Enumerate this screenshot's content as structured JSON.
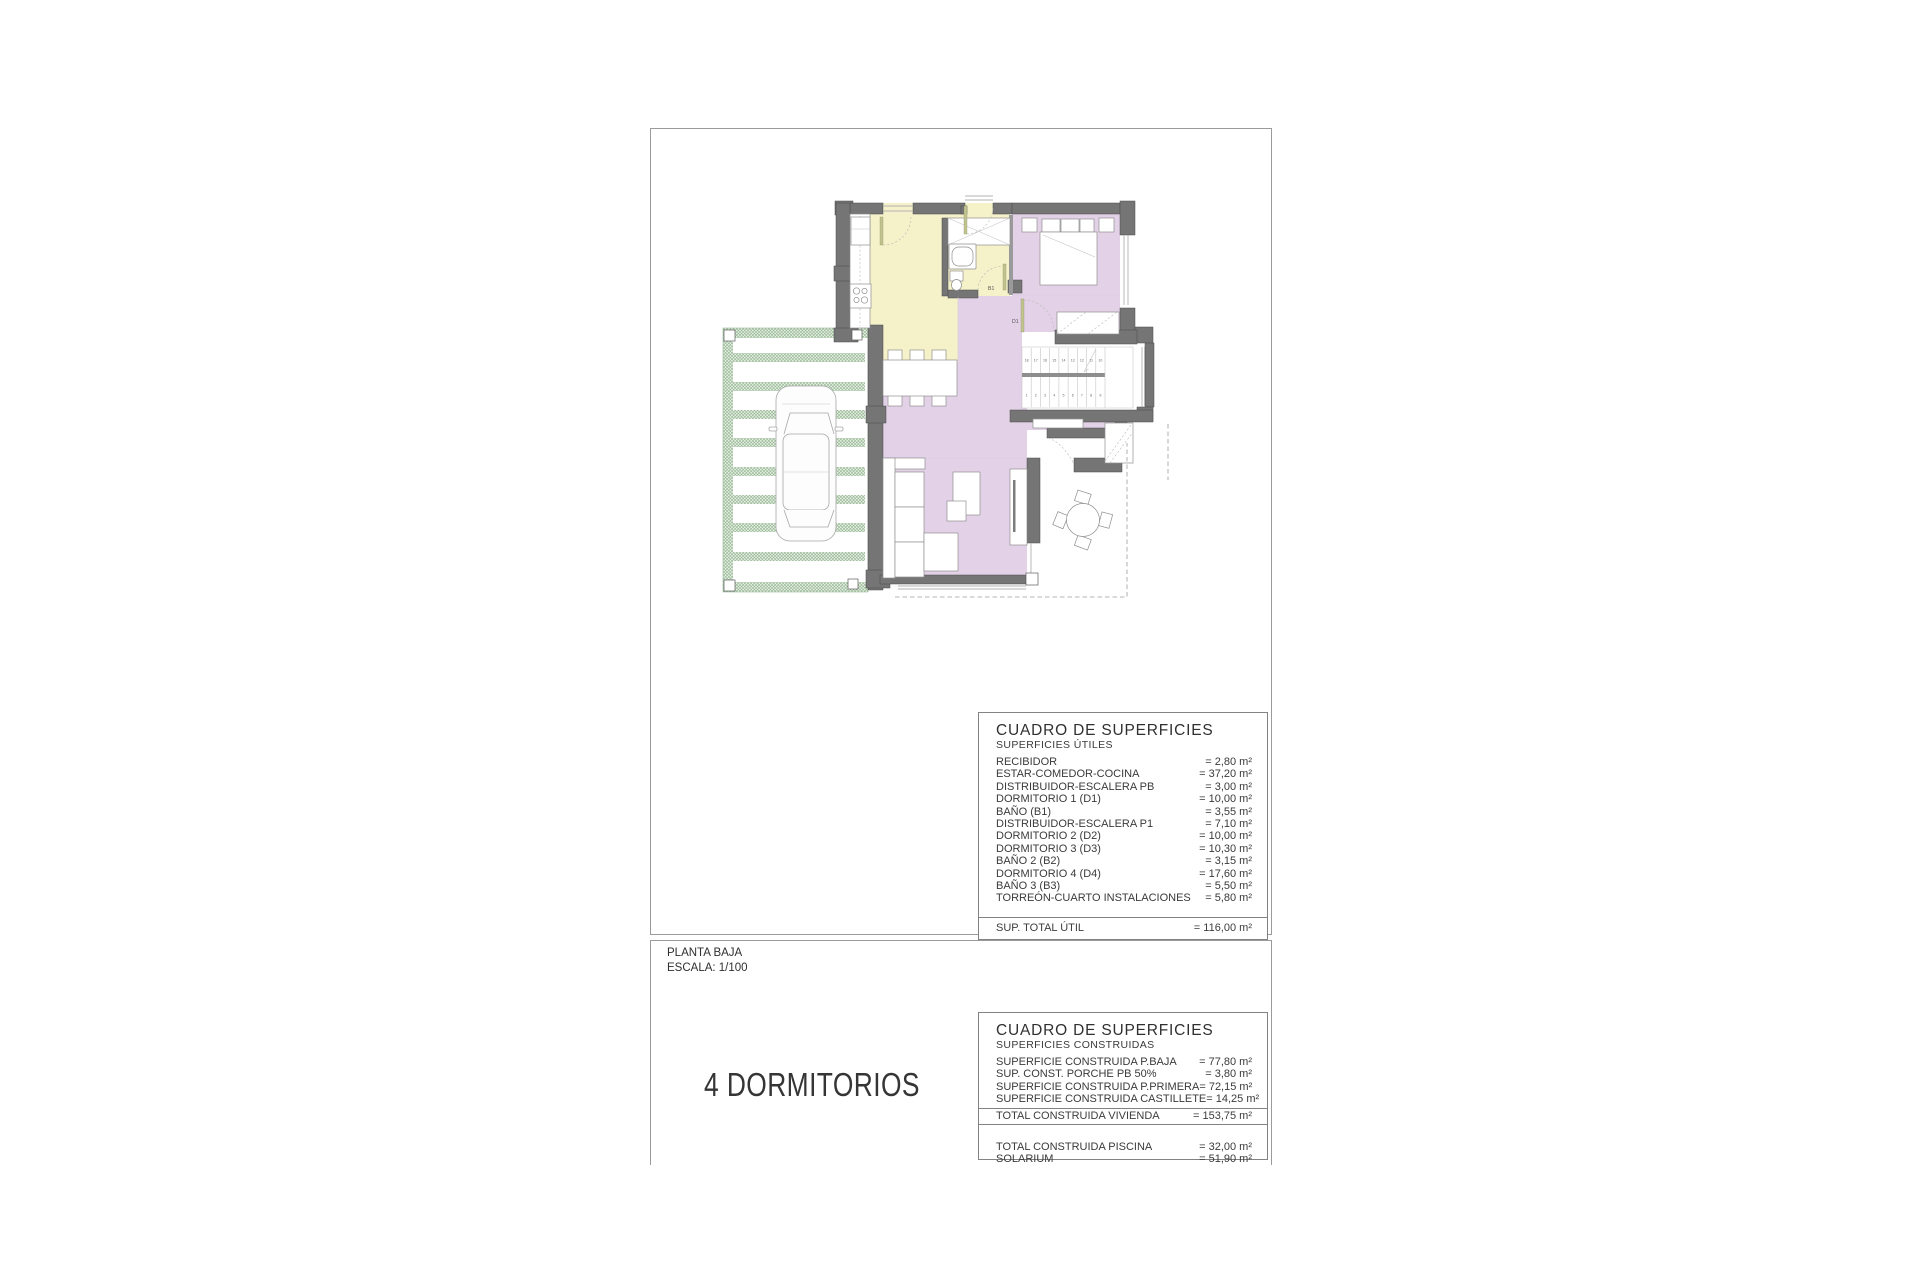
{
  "title_block": {
    "plan_name": "PLANTA BAJA",
    "scale": "ESCALA: 1/100",
    "dormitorios": "4 DORMITORIOS"
  },
  "tables": {
    "utiles": {
      "title": "CUADRO DE SUPERFICIES",
      "subtitle": "SUPERFICIES ÚTILES",
      "rows": [
        {
          "label": "RECIBIDOR",
          "value": "= 2,80 m²"
        },
        {
          "label": "ESTAR-COMEDOR-COCINA",
          "value": "= 37,20 m²"
        },
        {
          "label": "DISTRIBUIDOR-ESCALERA PB",
          "value": "= 3,00 m²"
        },
        {
          "label": "DORMITORIO 1 (D1)",
          "value": "= 10,00 m²"
        },
        {
          "label": "BAÑO  (B1)",
          "value": "= 3,55 m²"
        },
        {
          "label": "DISTRIBUIDOR-ESCALERA P1",
          "value": "= 7,10 m²"
        },
        {
          "label": "DORMITORIO 2 (D2)",
          "value": "= 10,00 m²"
        },
        {
          "label": "DORMITORIO 3 (D3)",
          "value": "= 10,30 m²"
        },
        {
          "label": "BAÑO 2 (B2)",
          "value": "= 3,15 m²"
        },
        {
          "label": "DORMITORIO 4 (D4)",
          "value": "= 17,60 m²"
        },
        {
          "label": "BAÑO 3 (B3)",
          "value": "= 5,50 m²"
        },
        {
          "label": "TORREÓN-CUARTO INSTALACIONES",
          "value": "= 5,80 m²"
        }
      ],
      "total": {
        "label": "SUP. TOTAL ÚTIL",
        "value": "= 116,00 m²"
      }
    },
    "construidas": {
      "title": "CUADRO DE SUPERFICIES",
      "subtitle": "SUPERFICIES CONSTRUIDAS",
      "rows": [
        {
          "label": "SUPERFICIE  CONSTRUIDA P.BAJA",
          "value": "= 77,80 m²"
        },
        {
          "label": "SUP. CONST. PORCHE PB 50%",
          "value": "= 3,80 m²"
        },
        {
          "label": "SUPERFICIE CONSTRUIDA P.PRIMERA",
          "value": "= 72,15 m²"
        },
        {
          "label": "SUPERFICIE CONSTRUIDA CASTILLETE",
          "value": "= 14,25 m²"
        }
      ],
      "total": {
        "label": "TOTAL CONSTRUIDA VIVIENDA",
        "value": "= 153,75 m²"
      },
      "extra_rows": [
        {
          "label": "TOTAL CONSTRUIDA PISCINA",
          "value": "= 32,00 m²"
        },
        {
          "label": "SOLARIUM",
          "value": "= 51,90 m²"
        }
      ]
    }
  },
  "plan": {
    "labels": {
      "bath": "B1",
      "bedroom": "D1"
    },
    "stairs": {
      "upper": [
        "18",
        "17",
        "16",
        "15",
        "14",
        "13",
        "12",
        "11",
        "10"
      ],
      "lower": [
        "1",
        "2",
        "3",
        "4",
        "5",
        "6",
        "7",
        "8",
        "9"
      ]
    },
    "colors": {
      "wall": "#757575",
      "kitchen_zone": "#f5f1c9",
      "living_zone": "#e3d2e7",
      "pergola_green": "#7fa97f"
    }
  }
}
